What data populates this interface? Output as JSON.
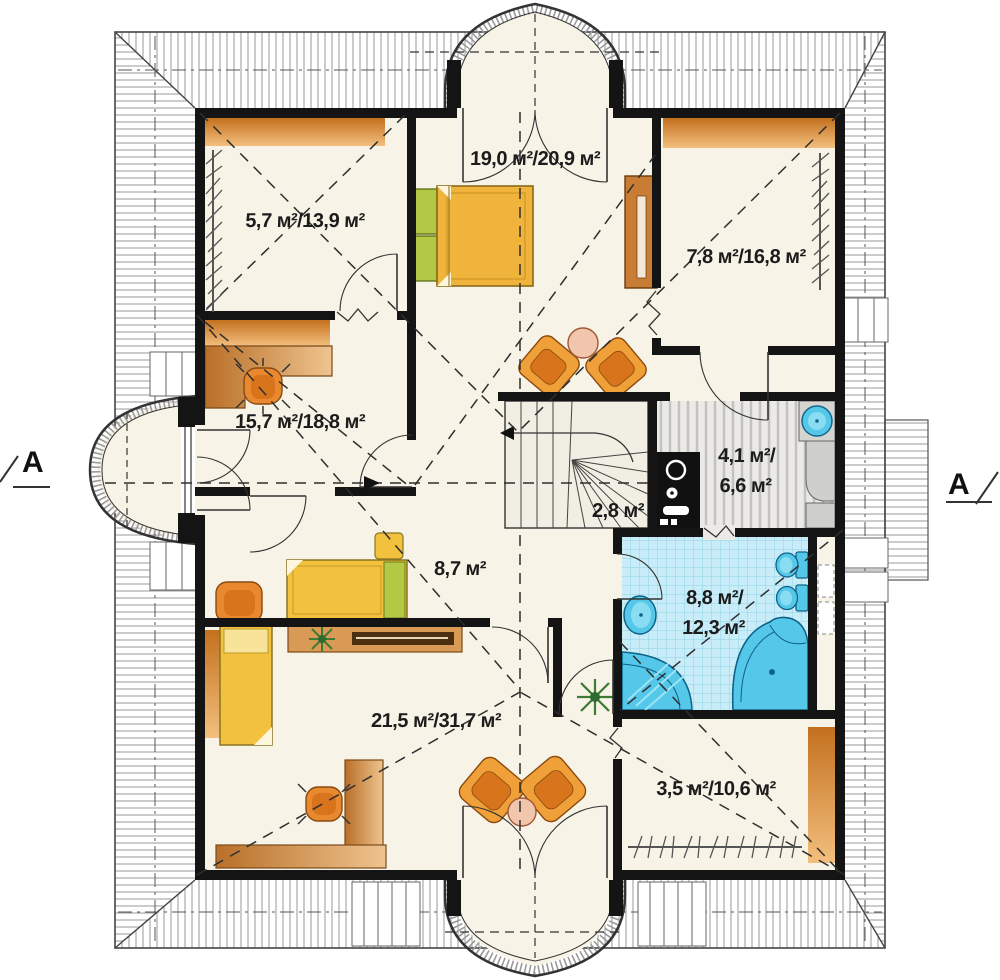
{
  "plan": {
    "title": "attic-floor-plan",
    "section_markers": {
      "left": "A",
      "right": "A"
    },
    "rooms": [
      {
        "name": "bedroom-top",
        "area": "19,0 м²/20,9 м²"
      },
      {
        "name": "room-top-left",
        "area": "5,7 м²/13,9 м²"
      },
      {
        "name": "room-top-right",
        "area": "7,8 м²/16,8 м²"
      },
      {
        "name": "room-mid-left",
        "area": "15,7 м²/18,8 м²"
      },
      {
        "name": "utility",
        "area_line1": "4,1 м²/",
        "area_line2": "6,6 м²"
      },
      {
        "name": "staircase",
        "area": "2,8 м²"
      },
      {
        "name": "hall",
        "area": "8,7 м²"
      },
      {
        "name": "bathroom",
        "area_line1": "8,8 м²/",
        "area_line2": "12,3 м²"
      },
      {
        "name": "living-bottom",
        "area": "21,5 м²/31,7 м²"
      },
      {
        "name": "wardrobe-bottom-right",
        "area": "3,5 м²/10,6 м²"
      }
    ],
    "colors": {
      "wall": "#141414",
      "floor": "#f7f3e6",
      "hatch": "#9a9a9a",
      "orange": "#e8882f",
      "orangeDark": "#d8741c",
      "tan": "#d99a55",
      "yellow": "#f2c13e",
      "green": "#b3c945",
      "bathFill": "#c9edf8",
      "bathGrid": "#8ed3e6",
      "fixture": "#55c8ea",
      "fixtureDark": "#0f6288",
      "grayFloor": "#eceae6",
      "grayStripe": "#c2c2be",
      "counter": "#cfcfcc",
      "pink": "#f2c6ac",
      "plant": "#3f7a35"
    }
  }
}
